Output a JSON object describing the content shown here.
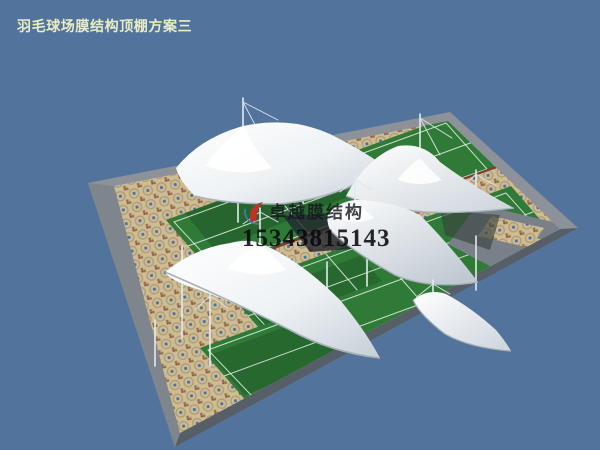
{
  "header": {
    "title": "羽毛球场膜结构顶棚方案三"
  },
  "watermark": {
    "company": "卓越膜结构",
    "phone": "15343815143"
  },
  "scene": {
    "type": "3d-architectural-render",
    "subject": "badminton-court-tensile-membrane-canopies",
    "colors": {
      "sky": "#52749c",
      "membrane_light": "#fbfdfe",
      "membrane_shade": "#c9d2da",
      "court_green": "#2f7a36",
      "court_green_shade": "#1d5226",
      "tile_beige": "#cdbd96",
      "platform_gray": "#8d929a",
      "platform_edge_dark": "#565e68",
      "court_trim_red": "#7e3c30",
      "title_text": "#e9edc6",
      "watermark_text": "#1c1c26",
      "logo_red": "#c03226",
      "logo_blue": "#4a78b8"
    }
  }
}
